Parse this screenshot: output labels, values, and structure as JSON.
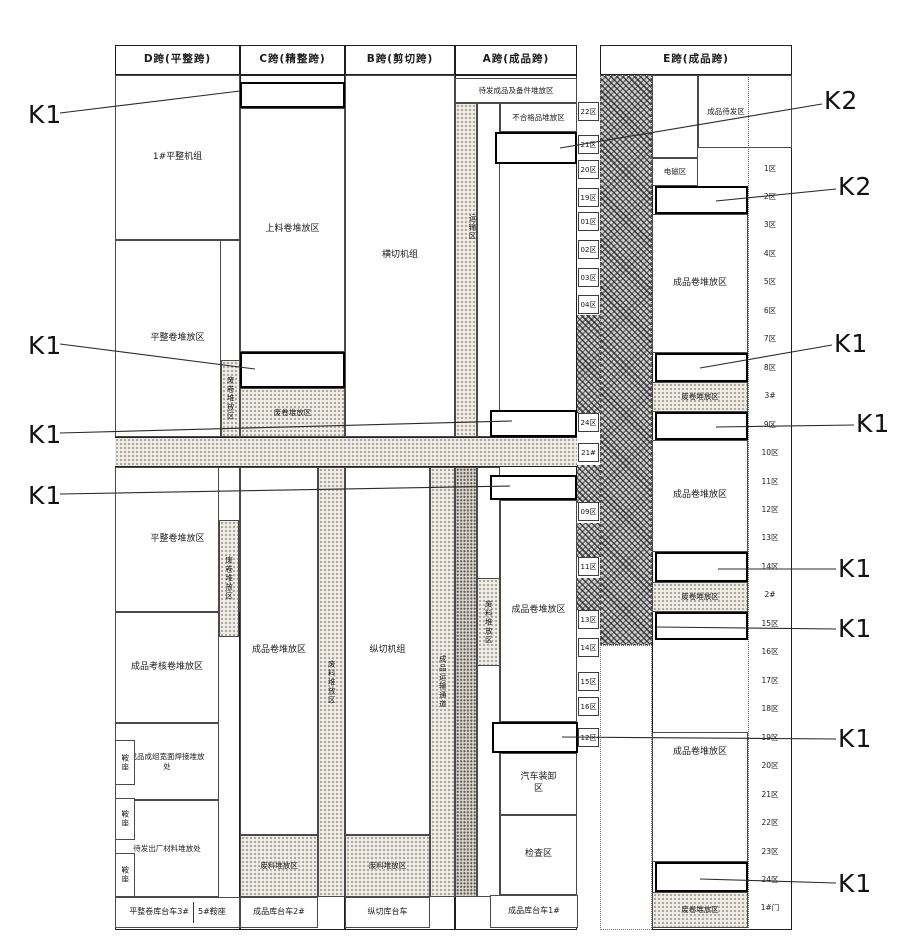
{
  "headers": {
    "d": "D跨(平整跨)",
    "c": "C跨(精整跨)",
    "b": "B跨(剪切跨)",
    "a": "A跨(成品跨)",
    "e": "E跨(成品跨)"
  },
  "d_col": {
    "machine": "1#平整机组",
    "coil_upper": "平整卷堆放区",
    "coil_lower": "平整卷堆放区",
    "assess": "成品考核卷堆放区",
    "weld": "成品成组宽面焊接堆放处",
    "outgoing": "待发出厂材料堆放处",
    "saddle1": "鞍座",
    "saddle2": "鞍座",
    "saddle3": "鞍座",
    "vscrap_upper": "废卷堆放区",
    "vscrap_lower": "废卷堆放区",
    "bottom_left": "平整卷库台车3#",
    "bottom_right": "5#鞍座"
  },
  "c_col": {
    "feed": "上料卷堆放区",
    "scrap_mid": "废卷堆放区",
    "coil": "成品卷堆放区",
    "vscrap": "废料堆放区",
    "scrap_bottom": "废料堆放区",
    "bottom": "成品库台车2#"
  },
  "b_col": {
    "cross_cut": "横切机组",
    "slit": "纵切机组",
    "vtransport": "成品运输通道",
    "scrap_bottom": "废料堆放区",
    "bottom": "纵切库台车"
  },
  "a_col": {
    "top": "待发成品及备件堆放区",
    "reject": "不合格品堆放区",
    "vtransport": "运输区",
    "vscrap": "废料堆放区",
    "coil": "成品卷堆放区",
    "truck": "汽车装卸区",
    "inspect": "检查区",
    "bottom": "成品库台车1#"
  },
  "e_col": {
    "ready": "成品待发区",
    "magnet": "电磁区",
    "coil1": "成品卷堆放区",
    "scrap1": "废卷堆放区",
    "coil2": "成品卷堆放区",
    "scrap2": "废卷堆放区",
    "coil3": "成品卷堆放区",
    "scrap3": "废卷堆放区"
  },
  "corridor_zones": [
    "22区",
    "21区",
    "20区",
    "19区",
    "01区",
    "02区",
    "03区",
    "04区",
    "24区",
    "21#",
    "09区",
    "11区",
    "13区",
    "14区",
    "15区",
    "16区",
    "12区"
  ],
  "right_zones": [
    "1区",
    "2区",
    "3区",
    "4区",
    "5区",
    "6区",
    "7区",
    "8区",
    "3#",
    "9区",
    "10区",
    "11区",
    "12区",
    "13区",
    "14区",
    "2#",
    "15区",
    "16区",
    "17区",
    "18区",
    "19区",
    "20区",
    "21区",
    "22区",
    "23区",
    "24区",
    "1#门"
  ],
  "annotations": [
    "K1",
    "K1",
    "K1",
    "K1",
    "K2",
    "K2",
    "K1",
    "K1",
    "K1",
    "K1",
    "K1",
    "K1"
  ]
}
